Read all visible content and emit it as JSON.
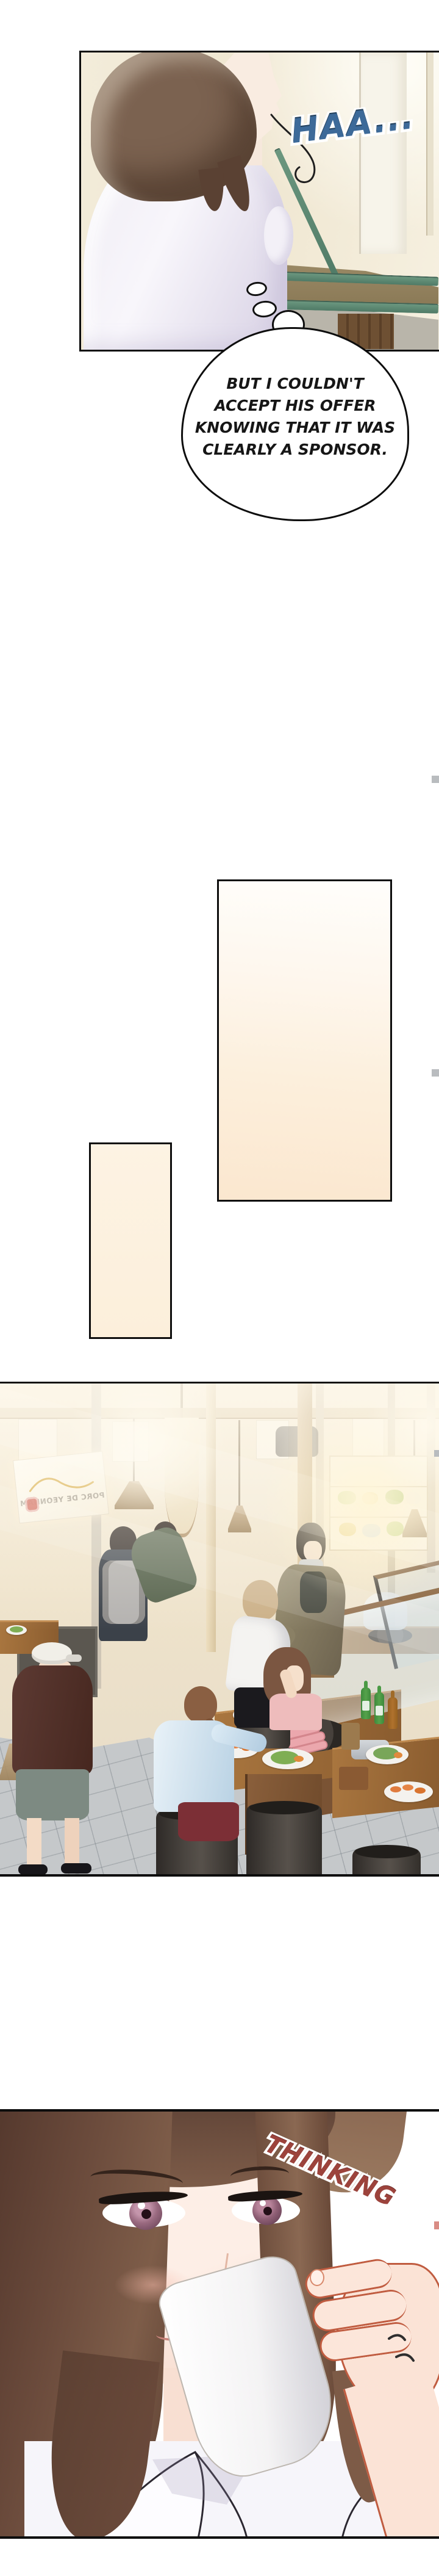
{
  "panel_stairwell": {
    "sfx_sigh": "HAA..."
  },
  "thought_bubble": {
    "lines": [
      "BUT I COULDN'T",
      "ACCEPT HIS OFFER",
      "KNOWING THAT IT WAS",
      "CLEARLY A SPONSOR."
    ]
  },
  "panel_restaurant": {
    "sign_text": "PORC DE YEONNAM"
  },
  "panel_drinking": {
    "sfx_thinking": "THINKING"
  },
  "colors": {
    "panel_border": "#0d0d0d",
    "sigh_blue": "#3d6a99",
    "thinking_red": "#9c433c",
    "bubble_text": "#161616",
    "placeholder_cream_light": "#fffefb",
    "placeholder_cream_dark": "#fbe7cf",
    "sign_logo_red": "#cc4f41",
    "railing_green": "#5d8a77",
    "soju_bottle_green": "#4f9b45",
    "floor_tile_gray": "#c5c8ca"
  }
}
